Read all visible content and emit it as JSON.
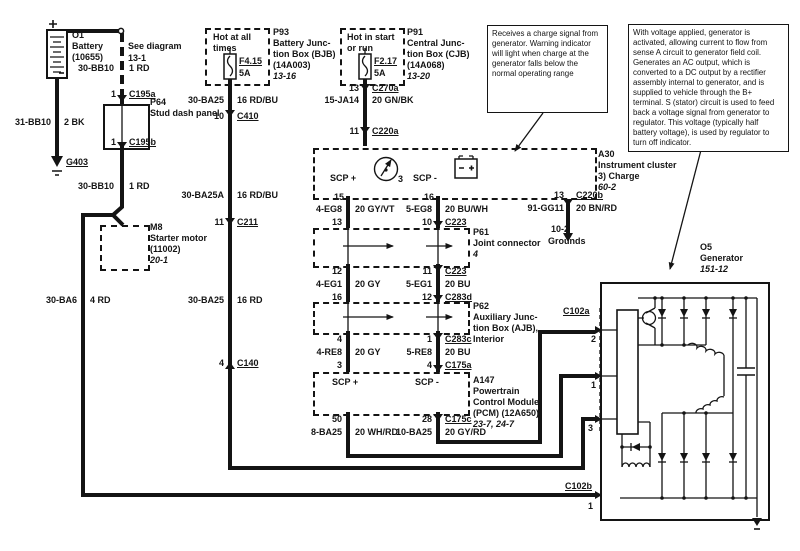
{
  "page": {
    "bg": "#ffffff",
    "ink": "#141414"
  },
  "battery": {
    "id": "O1",
    "name": "Battery",
    "part": "(10655)"
  },
  "see_diagram": {
    "line1": "See diagram",
    "line2": "13-1"
  },
  "ground_g403": {
    "label": "G403"
  },
  "grounds_ref": {
    "ref": "10-2",
    "label": "Grounds"
  },
  "p64": {
    "id": "P64",
    "name": "Stud dash panel",
    "pin_in": "1",
    "conn_in": "C195a",
    "pin_out": "1",
    "conn_out": "C195b"
  },
  "m8": {
    "id": "M8",
    "name": "Starter motor",
    "part": "(11002)",
    "ref": "20-1"
  },
  "p93": {
    "id": "P93",
    "name1": "Battery Junc-",
    "name2": "tion Box (BJB)",
    "name3": "(14A003)",
    "ref": "13-16",
    "hot1": "Hot at all",
    "hot2": "times",
    "fuse": "F4.15",
    "amps": "5A",
    "pin_out": "10",
    "conn_out": "C410"
  },
  "p91": {
    "id": "P91",
    "name1": "Central Junc-",
    "name2": "tion Box (CJB)",
    "name3": "(14A068)",
    "ref": "13-20",
    "hot1": "Hot in start",
    "hot2": "or run",
    "fuse": "F2.17",
    "amps": "5A",
    "pin_out": "13",
    "conn_out": "C270a"
  },
  "a30": {
    "id": "A30",
    "name": "Instrument cluster",
    "item": "3)  Charge",
    "ref": "60-2",
    "scp_plus": "SCP +",
    "scp_minus": "SCP -",
    "icon_num": "3",
    "pin_in": "11",
    "conn_in": "C220a",
    "pin_scp_plus": "15",
    "pin_scp_minus": "16",
    "pin_gnd": "13",
    "conn_gnd": "C220b"
  },
  "p61": {
    "id": "P61",
    "name": "Joint connector",
    "ref": "4",
    "pin_tl": "13",
    "pin_tr": "10",
    "conn_t": "C223",
    "pin_bl": "12",
    "pin_br": "11",
    "conn_b": "C223"
  },
  "p62": {
    "id": "P62",
    "name1": "Auxiliary Junc-",
    "name2": "tion Box (AJB),",
    "name3": "Interior",
    "pin_tl": "16",
    "pin_tr": "12",
    "conn_t": "C283d",
    "pin_bl": "4",
    "pin_br": "1",
    "conn_b": "C283c"
  },
  "a147": {
    "id": "A147",
    "name1": "Powertrain",
    "name2": "Control Module",
    "name3": "(PCM) (12A650)",
    "ref": "23-7, 24-7",
    "scp_plus": "SCP +",
    "scp_minus": "SCP -",
    "pin_tl": "3",
    "pin_tr": "4",
    "conn_t": "C175a",
    "pin_bl": "50",
    "pin_br": "28",
    "conn_b": "C175c"
  },
  "o5": {
    "id": "O5",
    "name": "Generator",
    "ref": "151-12",
    "conn_a": "C102a",
    "pin2": "2",
    "pin1": "1",
    "pin3": "3",
    "conn_b": "C102b",
    "pin_b": "1"
  },
  "wires": {
    "bb10_top": {
      "circuit": "30-BB10",
      "gauge": "1 RD"
    },
    "bb10_gnd": {
      "circuit": "31-BB10",
      "gauge": "2 BK"
    },
    "bb10_low": {
      "circuit": "30-BB10",
      "gauge": "1 RD"
    },
    "ba6": {
      "circuit": "30-BA6",
      "gauge": "4 RD"
    },
    "ba25_fuse": {
      "circuit": "30-BA25",
      "gauge": "16 RD/BU"
    },
    "ba25a": {
      "circuit": "30-BA25A",
      "gauge": "16 RD/BU"
    },
    "ba25_low": {
      "circuit": "30-BA25",
      "gauge": "16 RD"
    },
    "ja14": {
      "circuit": "15-JA14",
      "gauge": "20 GN/BK"
    },
    "gg11": {
      "circuit": "91-GG11",
      "gauge": "20 BN/RD"
    },
    "eg8_l": {
      "circuit": "4-EG8",
      "gauge": "20 GY/VT"
    },
    "eg8_r": {
      "circuit": "5-EG8",
      "gauge": "20 BU/WH"
    },
    "eg1_l": {
      "circuit": "4-EG1",
      "gauge": "20 GY"
    },
    "eg1_r": {
      "circuit": "5-EG1",
      "gauge": "20 BU"
    },
    "re8_l": {
      "circuit": "4-RE8",
      "gauge": "20 GY"
    },
    "re8_r": {
      "circuit": "5-RE8",
      "gauge": "20 BU"
    },
    "ba25_pcm_l": {
      "circuit": "8-BA25",
      "gauge": "20 WH/RD"
    },
    "ba25_pcm_r": {
      "circuit": "10-BA25",
      "gauge": "20 GY/RD"
    }
  },
  "notes": {
    "charge_indicator": "Receives a charge signal from generator. Warning indicator will light when charge at the generator falls below the normal operating range",
    "generator_operation": "With voltage applied, generator is activated, allowing current to flow from sense A circuit to generator field coil. Generates an AC output, which is converted to a DC output by a rectifier assembly internal to generator, and is supplied to vehicle through the B+ terminal.  S (stator) circuit is used to feed back a voltage signal from generator  to regulator. This voltage (typically half battery voltage), is used by regulator to turn off indicator."
  }
}
